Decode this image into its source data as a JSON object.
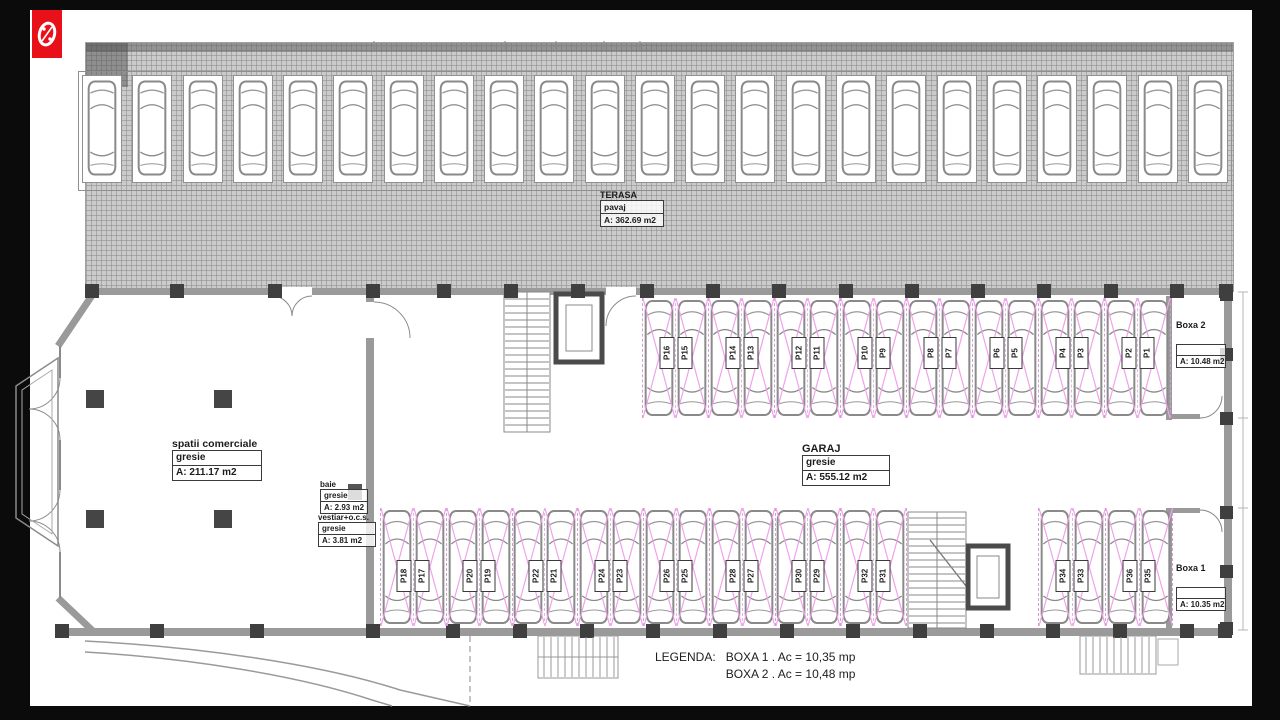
{
  "frame": {
    "color": "#0b0b0b"
  },
  "logo": {
    "icon": "percent-badge-icon",
    "color": "#e8111a"
  },
  "terasa": {
    "title": "TERASA",
    "rows": [
      "pavaj",
      "A: 362.69 m2"
    ],
    "car_count": 23
  },
  "rooms": {
    "spatii_comerciale": {
      "title": "spatii comerciale",
      "rows": [
        "gresie",
        "A: 211.17 m2"
      ]
    },
    "baie": {
      "title": "baie",
      "rows": [
        "gresie",
        "A: 2.93 m2"
      ]
    },
    "vestiar": {
      "title": "vestiar+o.c.s.",
      "rows": [
        "gresie",
        "A: 3.81 m2"
      ]
    },
    "garaj": {
      "title": "GARAJ",
      "rows": [
        "gresie",
        "A: 555.12 m2"
      ]
    },
    "boxa2": {
      "title": "Boxa 2",
      "rows": [
        "",
        "A: 10.48 m2"
      ]
    },
    "boxa1": {
      "title": "Boxa 1",
      "rows": [
        "",
        "A: 10.35 m2"
      ]
    }
  },
  "parking": {
    "top_row": [
      [
        "P16",
        "P15"
      ],
      [
        "P14",
        "P13"
      ],
      [
        "P12",
        "P11"
      ],
      [
        "P10",
        "P9"
      ],
      [
        "P8",
        "P7"
      ],
      [
        "P6",
        "P5"
      ],
      [
        "P4",
        "P3"
      ],
      [
        "P2",
        "P1"
      ]
    ],
    "bottom_row_left": [
      [
        "P18",
        "P17"
      ],
      [
        "P20",
        "P19"
      ],
      [
        "P22",
        "P21"
      ],
      [
        "P24",
        "P23"
      ],
      [
        "P26",
        "P25"
      ],
      [
        "P28",
        "P27"
      ],
      [
        "P30",
        "P29"
      ],
      [
        "P32",
        "P31"
      ]
    ],
    "bottom_row_right": [
      [
        "P34",
        "P33"
      ],
      [
        "P36",
        "P35"
      ]
    ]
  },
  "legend": {
    "label": "LEGENDA:",
    "lines": [
      "BOXA 1 . Ac = 10,35 mp",
      "BOXA 2 . Ac = 10,48 mp"
    ]
  },
  "colors": {
    "cross": "#f0a2ea",
    "hatch_bg": "#cbcbcb",
    "wall": "#9a9a9a",
    "pillar": "#3f3f3f",
    "frame": "#0b0b0b",
    "logo_red": "#e8111a"
  }
}
